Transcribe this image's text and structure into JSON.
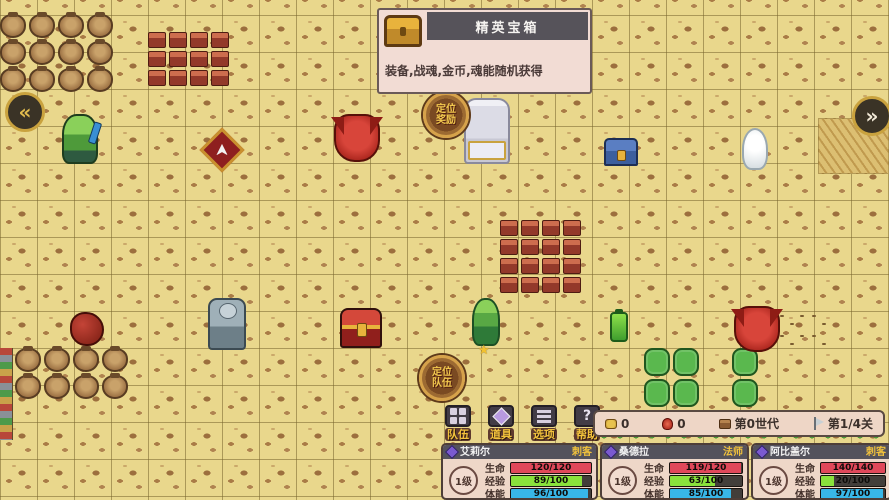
{
  "tooltip": {
    "title": "精英宝箱",
    "desc": "装备,战魂,金币,魂能随机获得"
  },
  "nav": {
    "left": "«",
    "right": "»"
  },
  "badges": {
    "top": {
      "line1": "定位",
      "line2": "奖励"
    },
    "bottom": {
      "line1": "定位",
      "line2": "队伍"
    }
  },
  "menu": {
    "buttons": [
      {
        "id": "team",
        "label": "队伍",
        "icon": "team-icon"
      },
      {
        "id": "items",
        "label": "道具",
        "icon": "item-icon"
      },
      {
        "id": "options",
        "label": "选项",
        "icon": "options-icon"
      },
      {
        "id": "help",
        "label": "帮助",
        "icon": "help-icon",
        "glyph": "?"
      }
    ]
  },
  "status_bar": {
    "items": [
      {
        "icon": "gold-icon",
        "text": "0"
      },
      {
        "icon": "soul-icon",
        "text": "0"
      },
      {
        "icon": "generation-icon",
        "text": "第0世代"
      },
      {
        "icon": "stage-icon",
        "text": "第1/4关"
      }
    ]
  },
  "party": [
    {
      "name": "艾莉尔",
      "class": "刺客",
      "level": "1级",
      "stats": [
        {
          "label": "生命",
          "value": "120/120",
          "pct": 100,
          "color": "#e0485a"
        },
        {
          "label": "经验",
          "value": "89/100",
          "pct": 89,
          "color": "#8ae23c"
        },
        {
          "label": "体能",
          "value": "96/100",
          "pct": 96,
          "color": "#38b7e8"
        }
      ]
    },
    {
      "name": "桑德拉",
      "class": "法师",
      "level": "1级",
      "stats": [
        {
          "label": "生命",
          "value": "119/120",
          "pct": 99,
          "color": "#e0485a"
        },
        {
          "label": "经验",
          "value": "63/100",
          "pct": 63,
          "color": "#8ae23c"
        },
        {
          "label": "体能",
          "value": "85/100",
          "pct": 85,
          "color": "#38b7e8"
        }
      ]
    },
    {
      "name": "阿比盖尔",
      "class": "刺客",
      "level": "1级",
      "stats": [
        {
          "label": "生命",
          "value": "140/140",
          "pct": 100,
          "color": "#e0485a"
        },
        {
          "label": "经验",
          "value": "20/100",
          "pct": 20,
          "color": "#8ae23c"
        },
        {
          "label": "体能",
          "value": "97/100",
          "pct": 97,
          "color": "#38b7e8"
        }
      ]
    }
  ],
  "map": {
    "sprites": [
      {
        "type": "pots",
        "x": 0,
        "y": 14,
        "w": 118,
        "h": 110,
        "count": 12
      },
      {
        "type": "pots",
        "x": 15,
        "y": 348,
        "w": 126,
        "h": 88,
        "count": 8
      },
      {
        "type": "bricks",
        "x": 148,
        "y": 32,
        "w": 86,
        "h": 62,
        "count": 12
      },
      {
        "type": "bricks",
        "x": 500,
        "y": 220,
        "w": 82,
        "h": 82,
        "count": 16
      },
      {
        "type": "straw",
        "x": 818,
        "y": 118,
        "w": 71,
        "h": 56
      },
      {
        "type": "footprints",
        "x": 776,
        "y": 310,
        "w": 56,
        "h": 42
      },
      {
        "type": "totem",
        "x": 0,
        "y": 348,
        "w": 13,
        "h": 92
      },
      {
        "type": "cacti",
        "x": 644,
        "y": 348,
        "w": 64,
        "h": 66,
        "count": 4
      },
      {
        "type": "cacti",
        "x": 732,
        "y": 348,
        "w": 34,
        "h": 64,
        "count": 2
      },
      {
        "type": "bushes",
        "x": 596,
        "y": 430,
        "w": 290,
        "h": 12
      },
      {
        "type": "goblin",
        "x": 62,
        "y": 114,
        "w": 36,
        "h": 50
      },
      {
        "type": "emblem",
        "x": 206,
        "y": 134,
        "w": 32,
        "h": 32
      },
      {
        "type": "dragon",
        "x": 334,
        "y": 114,
        "w": 46,
        "h": 48
      },
      {
        "type": "altar",
        "x": 464,
        "y": 98,
        "w": 46,
        "h": 66
      },
      {
        "type": "chest-blue",
        "x": 604,
        "y": 138,
        "w": 34,
        "h": 28
      },
      {
        "type": "wisp",
        "x": 742,
        "y": 128,
        "w": 26,
        "h": 42
      },
      {
        "type": "blob",
        "x": 70,
        "y": 312,
        "w": 34,
        "h": 34
      },
      {
        "type": "knight",
        "x": 208,
        "y": 298,
        "w": 38,
        "h": 52
      },
      {
        "type": "chest-elite",
        "x": 340,
        "y": 308,
        "w": 42,
        "h": 40
      },
      {
        "type": "plant-hero",
        "x": 472,
        "y": 298,
        "w": 28,
        "h": 48
      },
      {
        "type": "star",
        "x": 478,
        "y": 344,
        "w": 14,
        "h": 14
      },
      {
        "type": "bottle",
        "x": 610,
        "y": 312,
        "w": 18,
        "h": 30
      },
      {
        "type": "dragon",
        "x": 734,
        "y": 306,
        "w": 46,
        "h": 46
      }
    ]
  }
}
